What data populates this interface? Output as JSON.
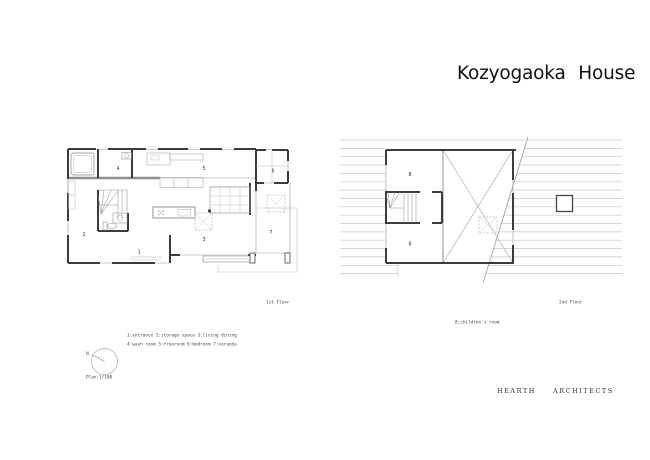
{
  "title": "Kozyogaoka House",
  "plans": {
    "first": {
      "caption": "1st Floor",
      "rooms": {
        "r1": "1",
        "r2": "2",
        "r3": "3",
        "r4": "4",
        "r5": "5",
        "r6": "6",
        "r7": "7"
      }
    },
    "second": {
      "caption": "2nd Floor",
      "rooms": {
        "r8a": "8",
        "r8b": "8"
      }
    }
  },
  "legend": {
    "line1": "1:entrance 2:storage space 3:living dining",
    "line2": "4:wash room 5:freeroom 6:bedroom 7:veranda",
    "children": "8:children's room"
  },
  "north": {
    "label": "N",
    "scale": "Plan:1/100"
  },
  "footer": {
    "firm": "HEARTH  ARCHITECTS"
  },
  "colors": {
    "wall": "#3b3b3b",
    "thin": "#999999",
    "roof": "#c7c7c7",
    "text": "#333333"
  }
}
